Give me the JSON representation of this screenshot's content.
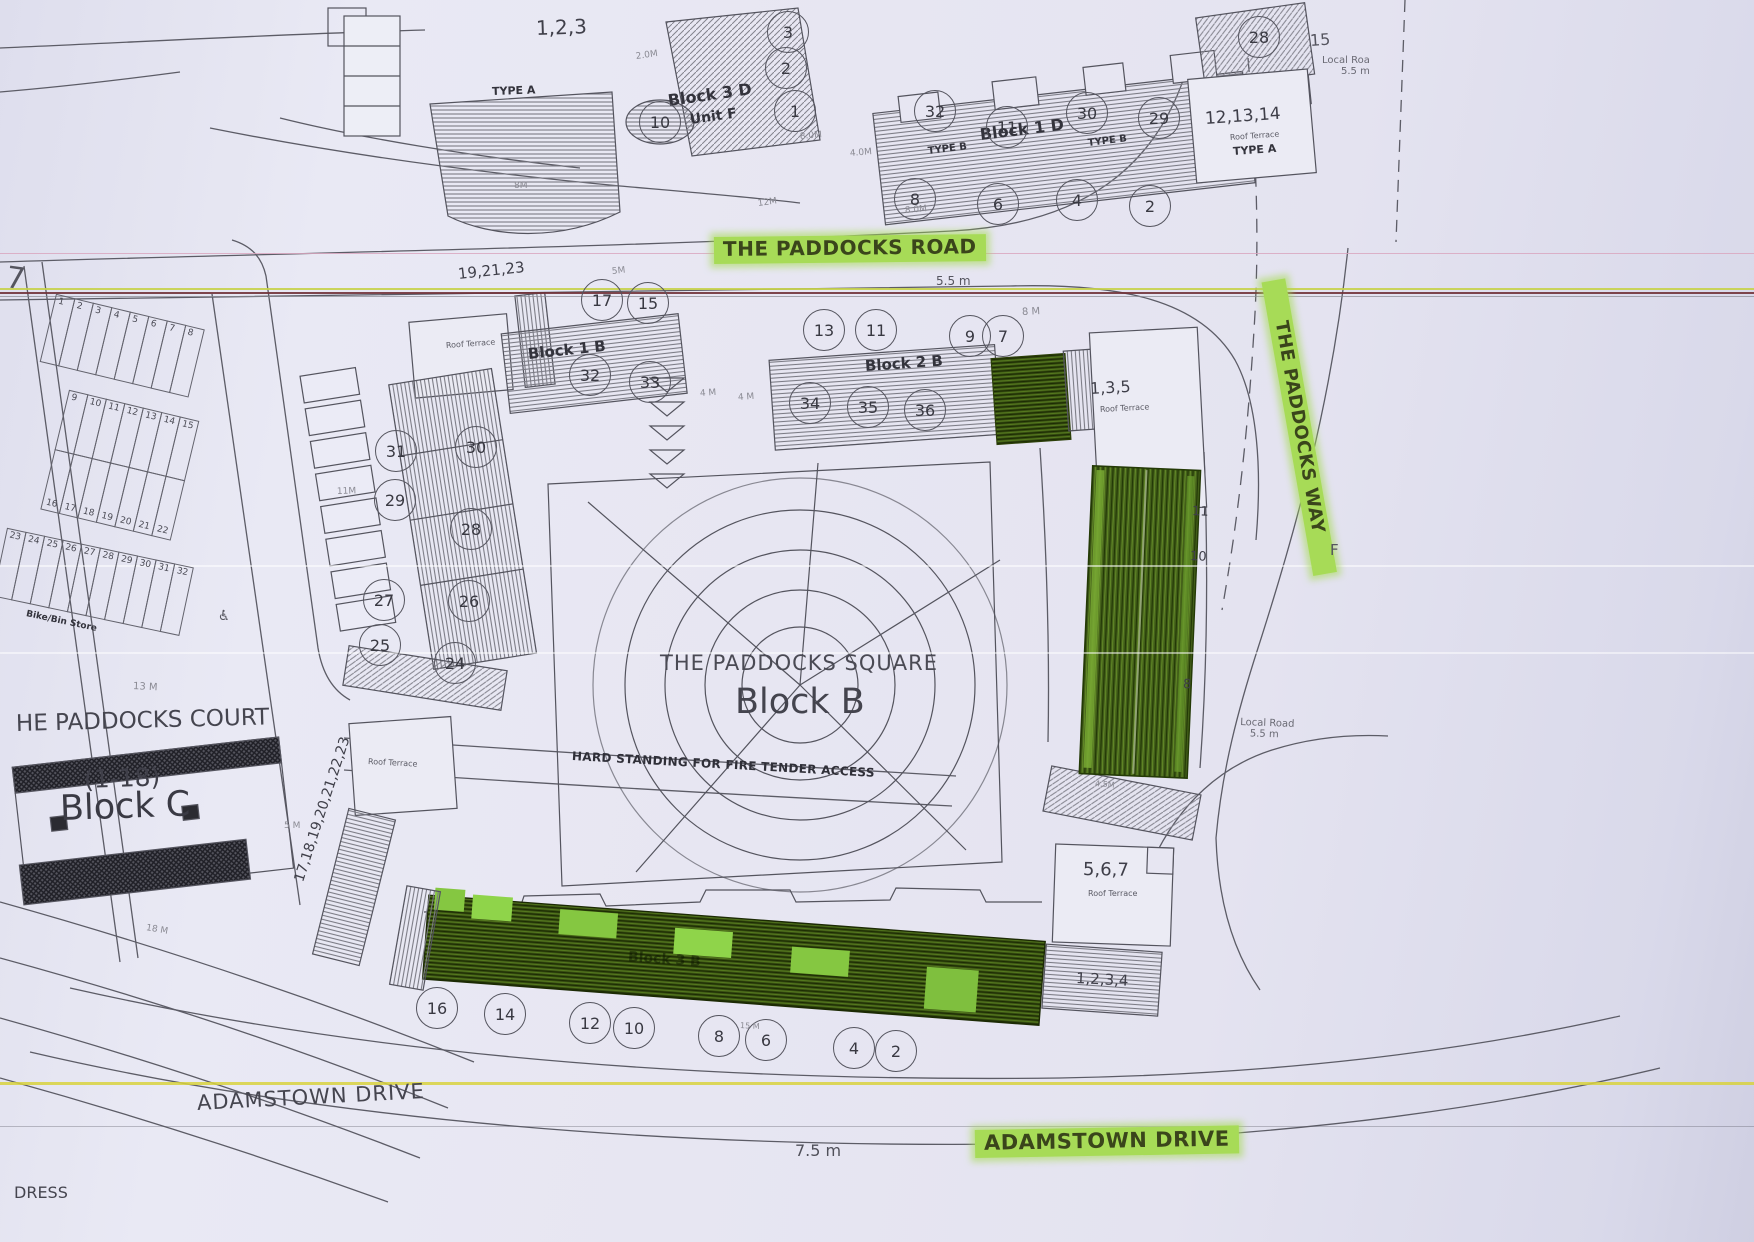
{
  "colors": {
    "paper": "#e6e6f1",
    "ink": "#3f3f49",
    "highlight_green": "#a7db57",
    "building_green": "#3c5414"
  },
  "top_left": {
    "units": "1,2,3",
    "type_label": "TYPE A",
    "edge_cut_text": "7"
  },
  "block_3d": {
    "name": "Block 3 D",
    "unit": "Unit F",
    "circles": [
      "3",
      "2",
      "1",
      "10"
    ]
  },
  "block_1d": {
    "name": "Block 1 D",
    "type_b_left": "TYPE B",
    "type_b_right": "TYPE B",
    "circles_top": [
      "32",
      "11",
      "30",
      "29"
    ],
    "circles_bottom": [
      "8",
      "6",
      "4",
      "2"
    ],
    "circle_28": "28",
    "label_15": "15"
  },
  "bldg_121314": {
    "units": "12,13,14",
    "roof": "Roof Terrace",
    "type_label": "TYPE A"
  },
  "local_road_ne": {
    "name": "Local Roa",
    "width": "5.5 m"
  },
  "paddocks_road": {
    "label": "THE PADDOCKS ROAD",
    "width": "5.5 m"
  },
  "block_1b": {
    "name": "Block 1 B",
    "units": "19,21,23",
    "roof": "Roof Terrace",
    "circles_top": [
      "17",
      "15"
    ],
    "circles_bottom": [
      "32",
      "33"
    ]
  },
  "block_2b": {
    "name": "Block 2 B",
    "circles_top": [
      "13",
      "11",
      "9",
      "7"
    ],
    "circles_bottom": [
      "34",
      "35",
      "36"
    ]
  },
  "bldg_135": {
    "units": "1,3,5",
    "roof": "Roof Terrace"
  },
  "paddocks_way": {
    "label": "THE PADDOCKS WAY"
  },
  "east_side": {
    "f_label": "F",
    "unit_11": "11",
    "unit_10": "10",
    "unit_8": "8",
    "local_road": "Local Road",
    "width": "5.5 m"
  },
  "parking": {
    "row1": [
      "1",
      "2",
      "3",
      "4",
      "5",
      "6",
      "7",
      "8"
    ],
    "row2": [
      "9",
      "10",
      "11",
      "12",
      "13",
      "14",
      "15"
    ],
    "row3": [
      "16",
      "17",
      "18",
      "19",
      "20",
      "21",
      "22"
    ],
    "row4": [
      "23",
      "24",
      "25",
      "26",
      "27",
      "28",
      "29",
      "30",
      "31",
      "32"
    ],
    "store": "Bike/Bin Store",
    "accessible_icon": "♿"
  },
  "west_building": {
    "circles_left": [
      "31",
      "29",
      "27",
      "25"
    ],
    "circles_right": [
      "30",
      "28",
      "26",
      "24"
    ]
  },
  "square": {
    "title": "THE PADDOCKS SQUARE",
    "name": "Block B",
    "fire_access": "HARD STANDING FOR FIRE TENDER ACCESS"
  },
  "block_c": {
    "court": "HE PADDOCKS COURT",
    "range": "(1-18)",
    "name": "Block C"
  },
  "southwest": {
    "units_rotated": "17,18,19,20,21,22,23",
    "roof": "Roof Terrace"
  },
  "block_3b": {
    "name": "Block 3 B",
    "circles": [
      "16",
      "14",
      "12",
      "10",
      "8",
      "6",
      "4",
      "2"
    ],
    "adj_units": "1,2,3,4"
  },
  "bldg_567": {
    "units": "5,6,7",
    "roof": "Roof Terrace"
  },
  "adamstown": {
    "plain": "ADAMSTOWN DRIVE",
    "width": "7.5 m",
    "highlighted": "ADAMSTOWN DRIVE"
  },
  "edge_cut": {
    "dress": "DRESS"
  },
  "dims": {
    "d20": "2.0M",
    "d8a": "8M",
    "d12": "12M",
    "d80a": "8.0M",
    "d80b": "8.0M",
    "d40": "4.0M",
    "d5": "5M",
    "d4a": "4 M",
    "d4b": "4 M",
    "d8e": "8 M",
    "d11": "11M",
    "d13": "13 M",
    "d5c": "5 M",
    "d18": "18 M",
    "d15": "15 M",
    "d45": "4.5M"
  }
}
